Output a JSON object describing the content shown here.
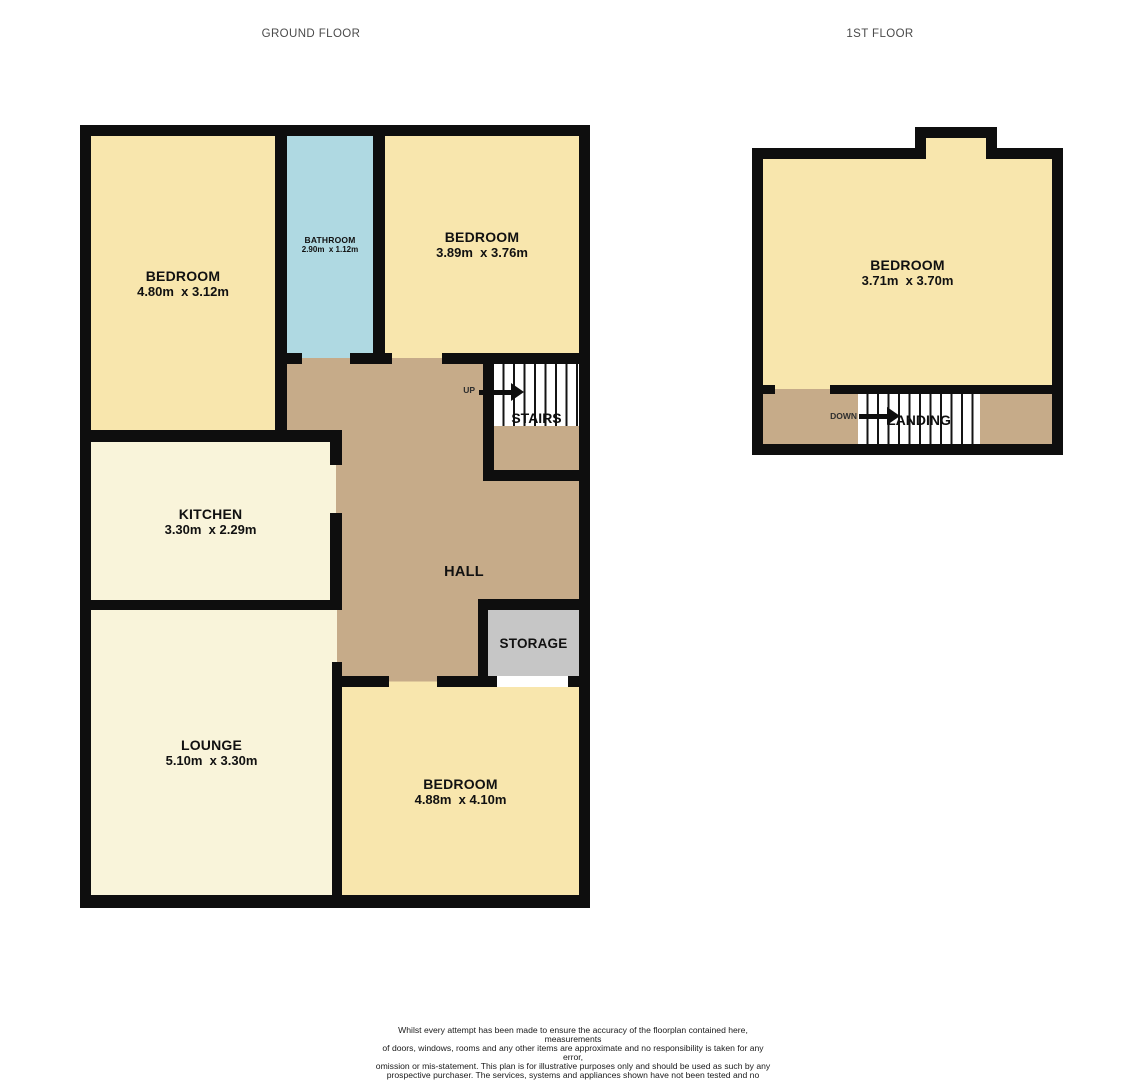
{
  "headers": {
    "ground_floor": "GROUND FLOOR",
    "first_floor": "1ST FLOOR"
  },
  "colors": {
    "wall": "#0e0e0e",
    "bedroom": "#f8e6ad",
    "bathroom": "#afd9e2",
    "kitchen": "#f9f4da",
    "lounge": "#f9f4da",
    "hall": "#c6ab89",
    "landing": "#c6ab89",
    "storage": "#c6c6c6",
    "stairs_background": "#ffffff"
  },
  "ground_floor": {
    "rooms": {
      "bedroom_top_left": {
        "name": "BEDROOM",
        "dims": "4.80m  x 3.12m"
      },
      "bathroom": {
        "name": "BATHROOM",
        "dims": "2.90m  x 1.12m"
      },
      "bedroom_top_right": {
        "name": "BEDROOM",
        "dims": "3.89m  x 3.76m"
      },
      "kitchen": {
        "name": "KITCHEN",
        "dims": "3.30m  x 2.29m"
      },
      "lounge": {
        "name": "LOUNGE",
        "dims": "5.10m  x 3.30m"
      },
      "bedroom_bottom": {
        "name": "BEDROOM",
        "dims": "4.88m  x 4.10m"
      },
      "hall": {
        "name": "HALL"
      },
      "storage": {
        "name": "STORAGE"
      },
      "stairs": {
        "name": "STAIRS",
        "direction": "UP"
      }
    }
  },
  "first_floor": {
    "rooms": {
      "bedroom": {
        "name": "BEDROOM",
        "dims": "3.71m  x 3.70m"
      },
      "landing": {
        "name": "LANDING",
        "direction": "DOWN"
      }
    }
  },
  "footer": {
    "disclaimer_lines": [
      "Whilst every attempt has been made to ensure the accuracy of the floorplan contained here, measurements",
      "of doors, windows, rooms and any other items are approximate and no responsibility is taken for any error,",
      "omission or mis-statement. This plan is for illustrative purposes only and should be used as such by any",
      "prospective purchaser. The services, systems and appliances shown have not been tested and no guarantee",
      "as to their operability or efficiency can be given."
    ],
    "credit": "Made with Metropix ©2024"
  }
}
